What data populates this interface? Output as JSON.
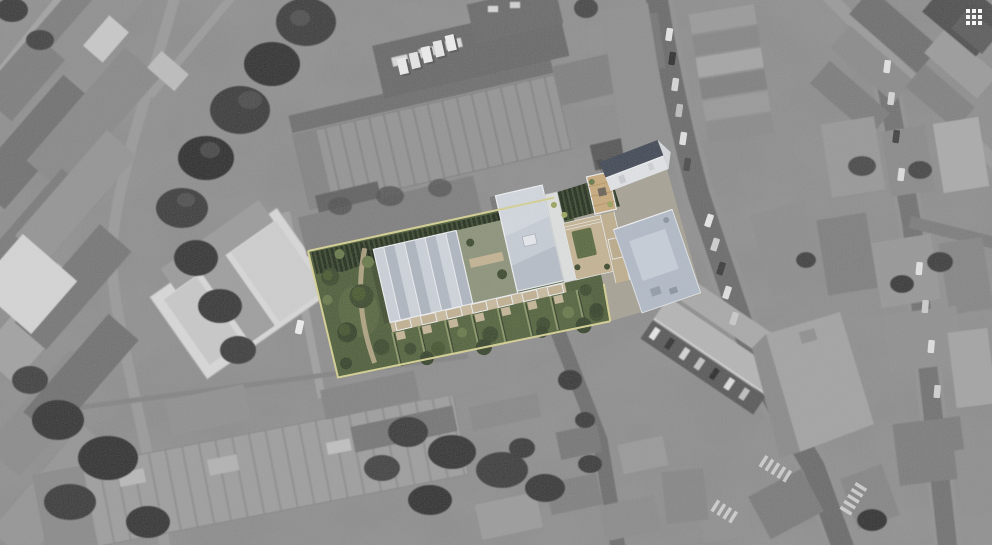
{
  "controls": {
    "apps_grid_button": {
      "icon": "grid-3x3-icon"
    }
  },
  "colors": {
    "site_boundary": "#d6d193",
    "lawn": "#4e5e3a",
    "lawn_light": "#64744a",
    "hedge_light": "#8a9668",
    "hedge_dark": "#2c3622",
    "planted_rows_dark": "#232d1b",
    "planted_rows_light": "#3c4930",
    "tree_dark": "#3c4a2d",
    "tree_light": "#69794a",
    "roof_gabled": "#c2c8d0",
    "roof_hipped": "#c8ced7",
    "roof_flat": "#b2bbc8",
    "roof_slate": "#414855",
    "terrace_tan": "#c9bb9e",
    "plaza_tan": "#c6b493",
    "deck_wood": "#c9aa7c",
    "trim_white": "#eef0f3"
  }
}
